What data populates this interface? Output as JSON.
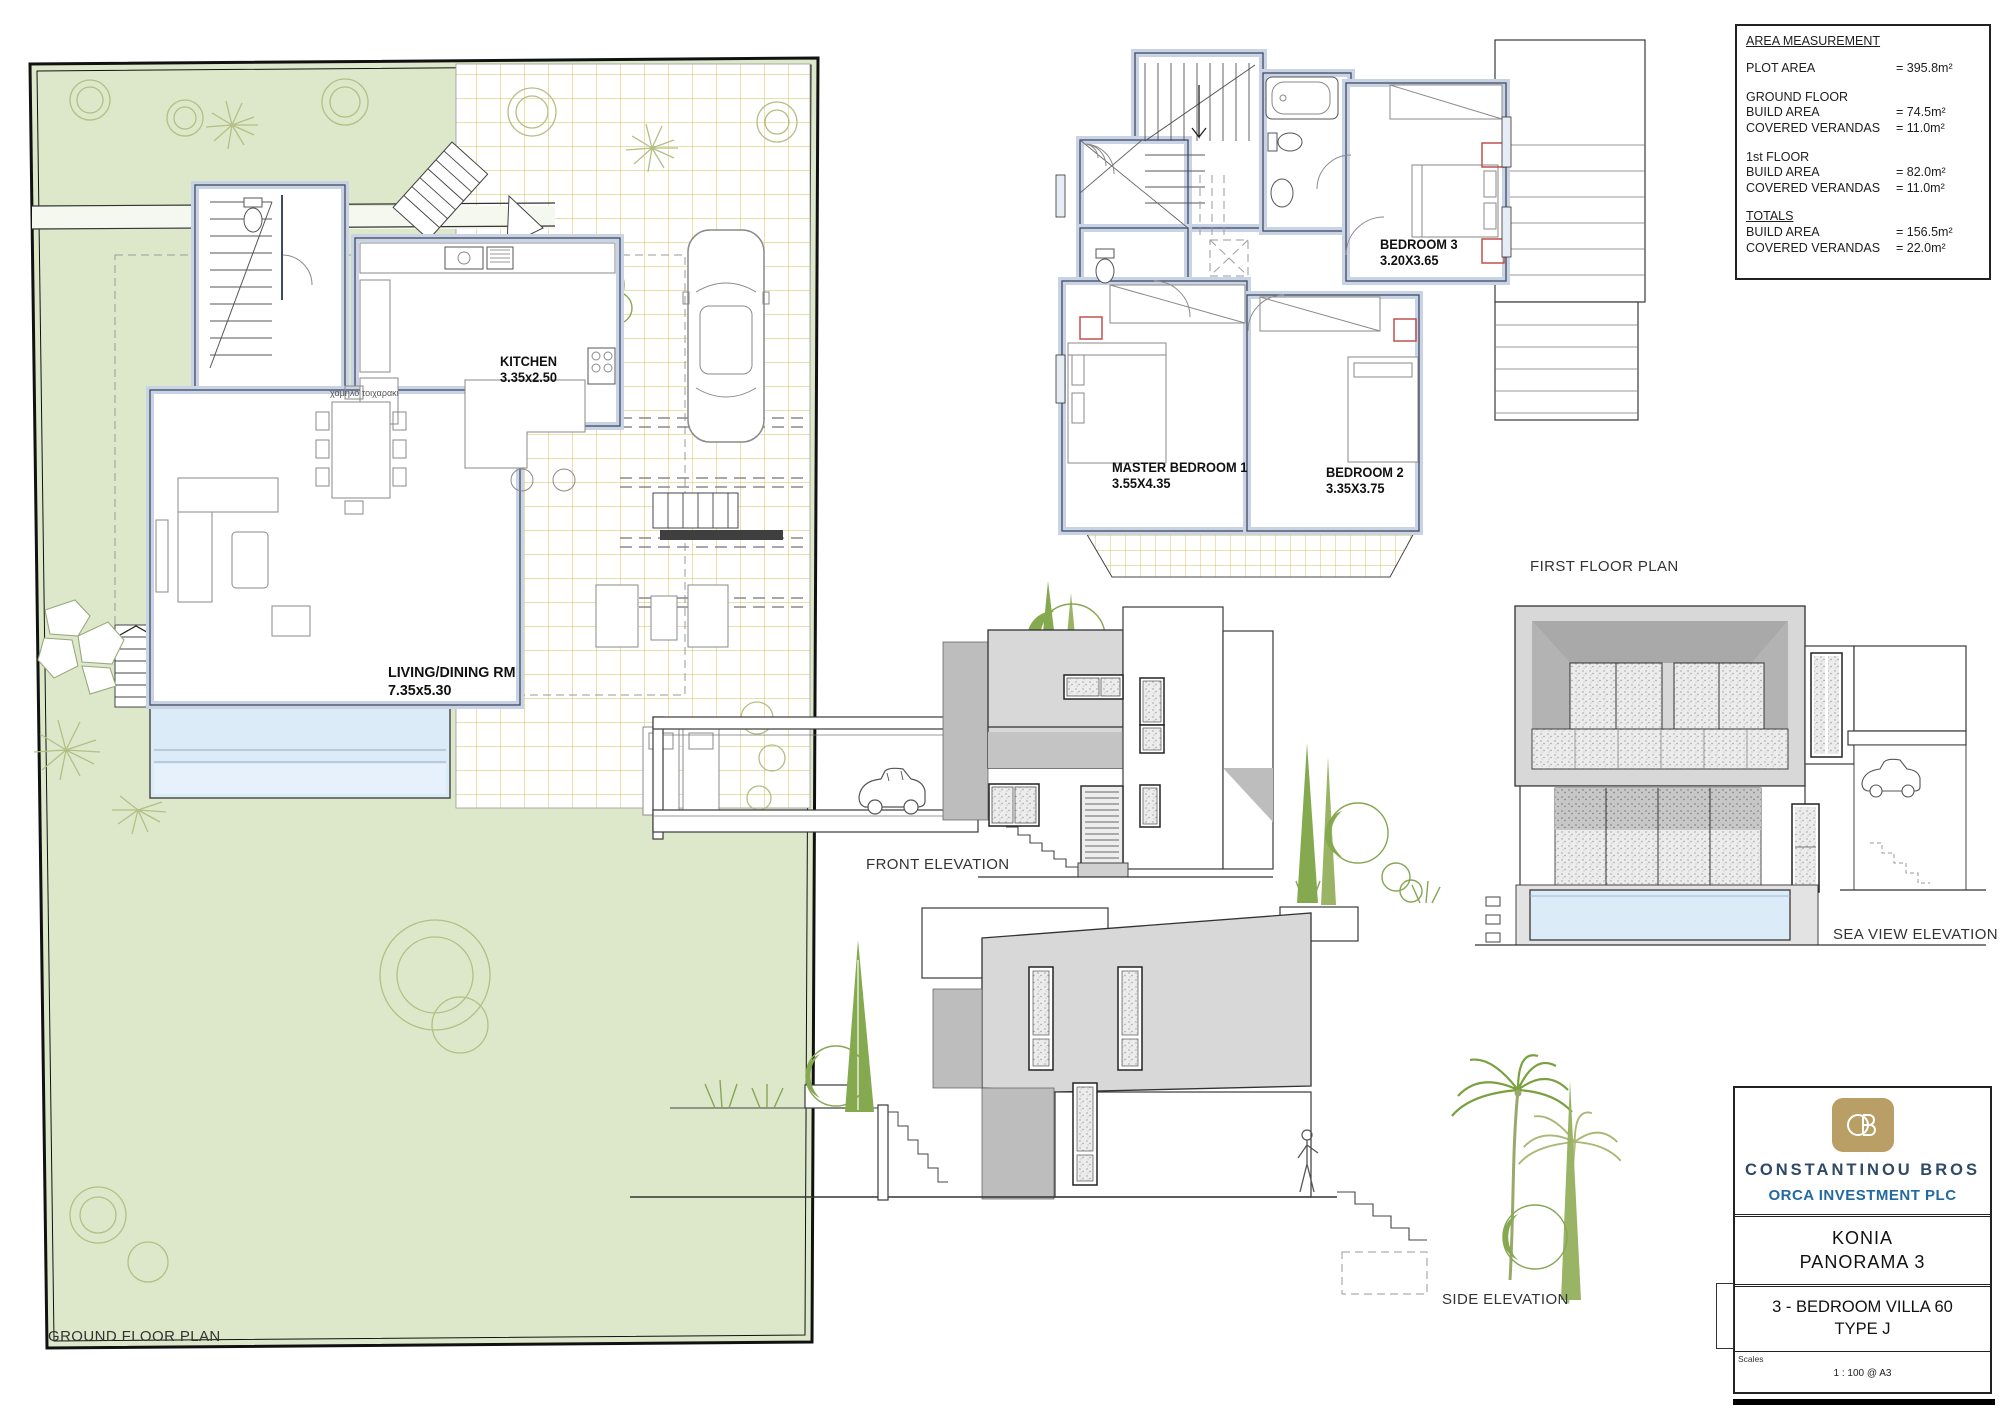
{
  "area_measurement": {
    "title": "AREA MEASUREMENT",
    "rows": [
      {
        "label": "PLOT AREA",
        "value": "= 395.8m²"
      },
      {
        "label": "GROUND FLOOR",
        "value": ""
      },
      {
        "label": "BUILD AREA",
        "value": "= 74.5m²"
      },
      {
        "label": "COVERED VERANDAS",
        "value": "= 11.0m²"
      },
      {
        "label": "1st FLOOR",
        "value": ""
      },
      {
        "label": "BUILD AREA",
        "value": "= 82.0m²"
      },
      {
        "label": "COVERED VERANDAS",
        "value": "= 11.0m²"
      },
      {
        "label": "TOTALS",
        "value": ""
      },
      {
        "label": "BUILD AREA",
        "value": "= 156.5m²"
      },
      {
        "label": "COVERED VERANDAS",
        "value": "= 22.0m²"
      }
    ]
  },
  "ground_floor_plan": {
    "title": "GROUND FLOOR PLAN",
    "rooms": {
      "kitchen": {
        "name": "KITCHEN",
        "dims": "3.35x2.50"
      },
      "living": {
        "name": "LIVING/DINING  RM",
        "dims": "7.35x5.30"
      }
    },
    "note": "χαμηλο τοιχαρακι"
  },
  "first_floor_plan": {
    "title": "FIRST FLOOR PLAN",
    "rooms": {
      "bedroom3": {
        "name": "BEDROOM  3",
        "dims": "3.20X3.65"
      },
      "master": {
        "name": "MASTER  BEDROOM  1",
        "dims": "3.55X4.35"
      },
      "bedroom2": {
        "name": "BEDROOM  2",
        "dims": "3.35X3.75"
      }
    }
  },
  "elevations": {
    "front": "FRONT ELEVATION",
    "sea_view": "SEA VIEW ELEVATION",
    "side": "SIDE ELEVATION"
  },
  "title_block": {
    "company": "CONSTANTINOU BROS",
    "plc": "ORCA INVESTMENT PLC",
    "project_line1": "KONIA",
    "project_line2": "PANORAMA 3",
    "drawing_line1": "3 - BEDROOM VILLA 60",
    "drawing_line2": "TYPE J",
    "scales_label": "Scales",
    "scale_value": "1 : 100 @ A3"
  },
  "colors": {
    "garden_green": "#dde8ca",
    "pool_blue": "#dcebf8",
    "wall_fill": "#c9d3e6",
    "tile_gold": "#d8bf5e",
    "elevation_gray": "#d8d8d8",
    "brand_navy": "#2e4a66",
    "brand_blue": "#2469a0",
    "logo_gold": "#b99f66",
    "accent_red": "#c0504d",
    "plant_olive": "#b3bf85",
    "plant_green": "#85a94f"
  }
}
